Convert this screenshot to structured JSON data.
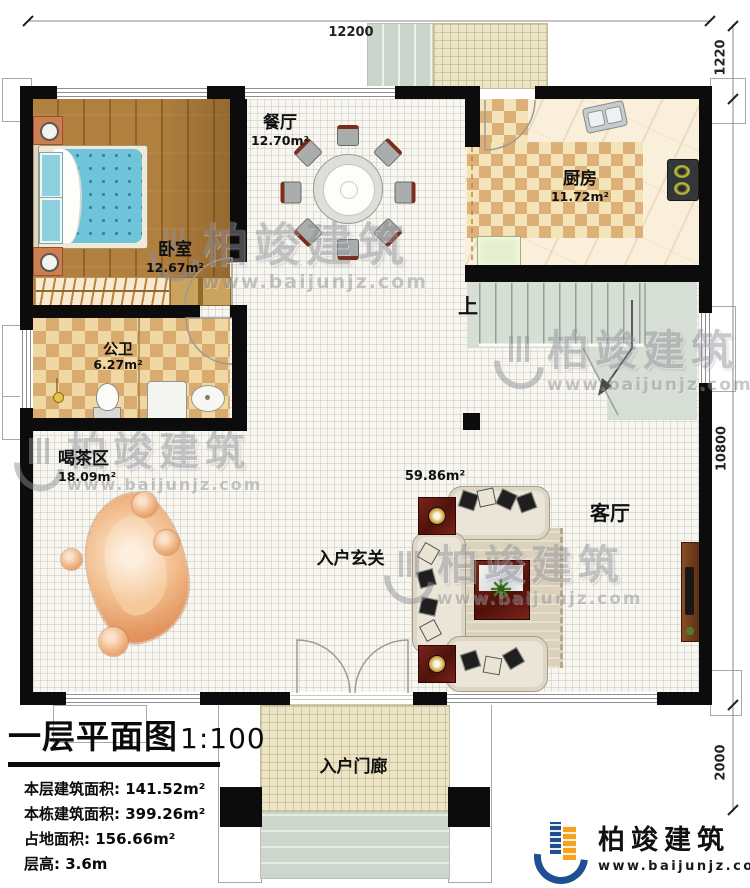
{
  "dimensions": {
    "top": "12200",
    "right_top": "1220",
    "right_middle": "10800",
    "right_bottom": "2000"
  },
  "rooms": {
    "dining": {
      "name": "餐厅",
      "area": "12.70m²"
    },
    "kitchen": {
      "name": "厨房",
      "area": "11.72m²"
    },
    "bedroom": {
      "name": "卧室",
      "area": "12.67m²"
    },
    "bathroom": {
      "name": "公卫",
      "area": "6.27m²"
    },
    "tea": {
      "name": "喝茶区",
      "area": "18.09m²"
    },
    "living": {
      "name": "客厅",
      "area": "59.86m²"
    },
    "foyer": {
      "name": "入户玄关"
    },
    "porch": {
      "name": "入户门廊"
    },
    "stairs_up": {
      "label": "上"
    }
  },
  "title_block": {
    "title": "一层平面图",
    "scale": "1:100",
    "info": [
      "本层建筑面积: 141.52m²",
      "本栋建筑面积: 399.26m²",
      "占地面积: 156.66m²",
      "层高: 3.6m"
    ]
  },
  "branding": {
    "company": "柏竣建筑",
    "website": "www.baijunjz.com"
  },
  "watermark": {
    "text": "柏竣建筑",
    "url": "www.baijunjz.com"
  },
  "colors": {
    "wall": "#0c0c0c",
    "wood_floor": "#b1803e",
    "checker_dark": "#d9ab6e",
    "checker_light": "#f0d8a4",
    "stair_floor": "#d6ded5",
    "accent_red": "#6e2117",
    "brand_blue": "#1d4f91",
    "brand_orange": "#f6a21c"
  }
}
